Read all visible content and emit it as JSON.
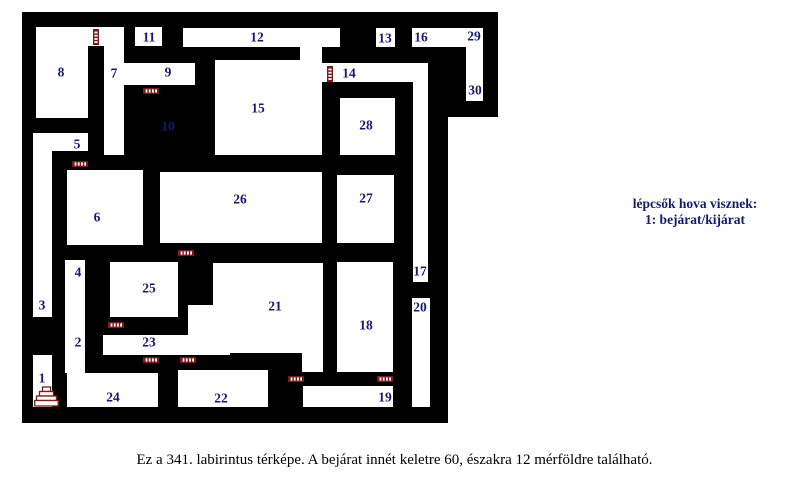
{
  "legend": {
    "line1": "lépcsők hova visznek:",
    "line2": "1: bejárat/kijárat",
    "color": "#191970"
  },
  "caption": {
    "text": "Ez a 341. labirintus térképe. A bejárat innét keletre 60, északra 12 mérföldre található."
  },
  "map": {
    "wall_color": "#000000",
    "floor_color": "#ffffff",
    "door_color": "#7a1a1a",
    "label_color": "#191970",
    "outline": [
      [
        22,
        12
      ],
      [
        498,
        12
      ],
      [
        498,
        117
      ],
      [
        448,
        117
      ],
      [
        448,
        423
      ],
      [
        22,
        423
      ]
    ],
    "rooms": [
      [
        36,
        27,
        88,
        19
      ],
      [
        36,
        27,
        52,
        91
      ],
      [
        104,
        27,
        20,
        128
      ],
      [
        104,
        63,
        91,
        22
      ],
      [
        135,
        27,
        27,
        19
      ],
      [
        183,
        28,
        157,
        19
      ],
      [
        300,
        40,
        22,
        24
      ],
      [
        376,
        28,
        19,
        19
      ],
      [
        412,
        28,
        71,
        19
      ],
      [
        466,
        28,
        17,
        73
      ],
      [
        215,
        60,
        107,
        95
      ],
      [
        322,
        63,
        106,
        19
      ],
      [
        413,
        63,
        15,
        219
      ],
      [
        340,
        98,
        55,
        57
      ],
      [
        337,
        175,
        57,
        68
      ],
      [
        337,
        262,
        56,
        110
      ],
      [
        412,
        298,
        18,
        109
      ],
      [
        303,
        386,
        90,
        21
      ],
      [
        160,
        172,
        162,
        71
      ],
      [
        213,
        263,
        110,
        90
      ],
      [
        188,
        305,
        25,
        50
      ],
      [
        302,
        353,
        21,
        19
      ],
      [
        110,
        262,
        68,
        55
      ],
      [
        103,
        335,
        127,
        20
      ],
      [
        67,
        170,
        76,
        75
      ],
      [
        33,
        133,
        55,
        18
      ],
      [
        33,
        133,
        19,
        184
      ],
      [
        65,
        260,
        20,
        113
      ],
      [
        33,
        355,
        19,
        52
      ],
      [
        67,
        373,
        91,
        34
      ],
      [
        178,
        370,
        90,
        37
      ]
    ],
    "labels": [
      {
        "n": "1",
        "x": 42,
        "y": 378
      },
      {
        "n": "2",
        "x": 78,
        "y": 342
      },
      {
        "n": "3",
        "x": 42,
        "y": 305
      },
      {
        "n": "4",
        "x": 78,
        "y": 272
      },
      {
        "n": "5",
        "x": 77,
        "y": 144
      },
      {
        "n": "6",
        "x": 97,
        "y": 217
      },
      {
        "n": "7",
        "x": 114,
        "y": 73
      },
      {
        "n": "8",
        "x": 61,
        "y": 72
      },
      {
        "n": "9",
        "x": 168,
        "y": 72
      },
      {
        "n": "10",
        "x": 168,
        "y": 126
      },
      {
        "n": "11",
        "x": 149,
        "y": 37
      },
      {
        "n": "12",
        "x": 257,
        "y": 37
      },
      {
        "n": "13",
        "x": 385,
        "y": 38
      },
      {
        "n": "14",
        "x": 349,
        "y": 73
      },
      {
        "n": "15",
        "x": 258,
        "y": 108
      },
      {
        "n": "16",
        "x": 421,
        "y": 37
      },
      {
        "n": "17",
        "x": 420,
        "y": 271
      },
      {
        "n": "18",
        "x": 366,
        "y": 325
      },
      {
        "n": "19",
        "x": 385,
        "y": 397
      },
      {
        "n": "20",
        "x": 420,
        "y": 307
      },
      {
        "n": "21",
        "x": 275,
        "y": 306
      },
      {
        "n": "22",
        "x": 221,
        "y": 398
      },
      {
        "n": "23",
        "x": 149,
        "y": 342
      },
      {
        "n": "24",
        "x": 113,
        "y": 397
      },
      {
        "n": "25",
        "x": 149,
        "y": 288
      },
      {
        "n": "26",
        "x": 240,
        "y": 199
      },
      {
        "n": "27",
        "x": 366,
        "y": 198
      },
      {
        "n": "28",
        "x": 366,
        "y": 125
      },
      {
        "n": "29",
        "x": 474,
        "y": 36
      },
      {
        "n": "30",
        "x": 475,
        "y": 90
      }
    ],
    "doors": [
      {
        "x": 93,
        "y": 29,
        "o": "v"
      },
      {
        "x": 143,
        "y": 88,
        "o": "h"
      },
      {
        "x": 327,
        "y": 66,
        "o": "v"
      },
      {
        "x": 72,
        "y": 161,
        "o": "h"
      },
      {
        "x": 178,
        "y": 250,
        "o": "h"
      },
      {
        "x": 108,
        "y": 322,
        "o": "h"
      },
      {
        "x": 143,
        "y": 357,
        "o": "h"
      },
      {
        "x": 180,
        "y": 357,
        "o": "h"
      },
      {
        "x": 288,
        "y": 376,
        "o": "h"
      },
      {
        "x": 377,
        "y": 376,
        "o": "h"
      }
    ],
    "stairs": {
      "x": 46.5,
      "y": 387
    }
  }
}
